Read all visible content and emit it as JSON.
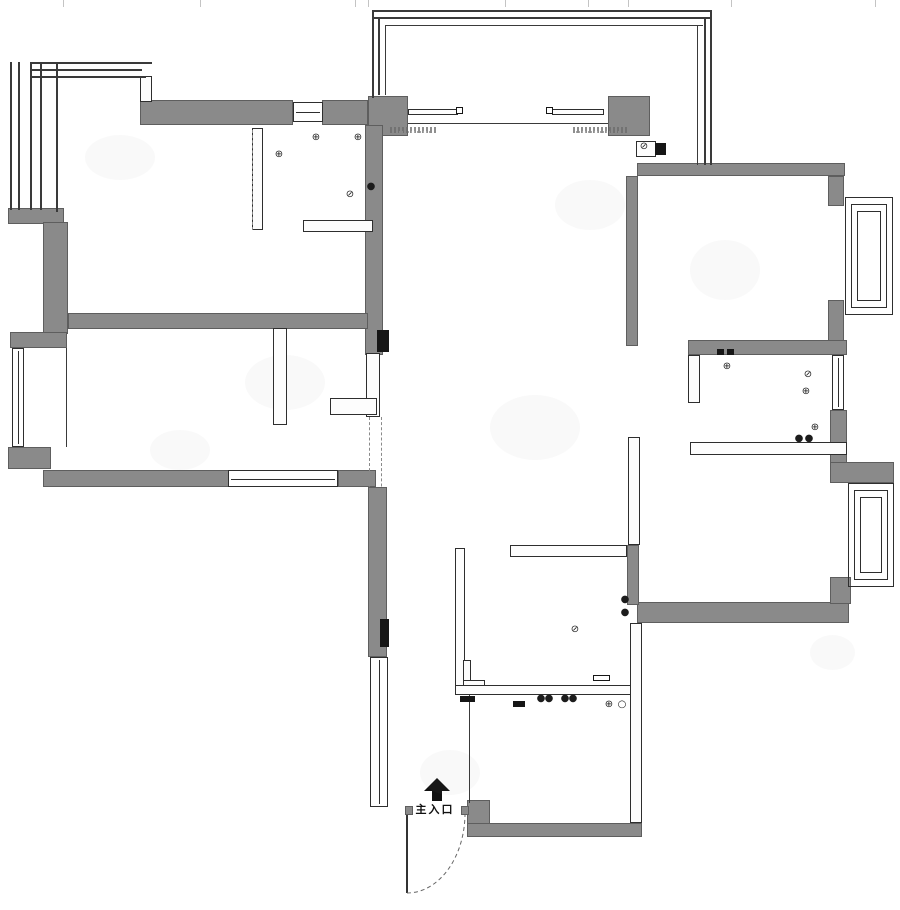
{
  "entrance": {
    "label": "主入口",
    "arrow_icon": "up-arrow-icon"
  },
  "palette": {
    "wall_fill": "#8a8a8a",
    "wall_edge": "#5e5e5e",
    "line": "#2e2e2e",
    "background": "#ffffff",
    "mark": "#161616",
    "faint": "#c4c4c4"
  },
  "plan": {
    "gray_walls": [
      [
        140,
        100,
        153,
        25
      ],
      [
        322,
        100,
        46,
        25
      ],
      [
        368,
        96,
        40,
        40
      ],
      [
        608,
        96,
        42,
        40
      ],
      [
        365,
        125,
        18,
        230
      ],
      [
        637,
        163,
        208,
        13
      ],
      [
        626,
        176,
        12,
        170
      ],
      [
        828,
        176,
        16,
        30
      ],
      [
        828,
        300,
        16,
        46
      ],
      [
        688,
        340,
        159,
        15
      ],
      [
        830,
        410,
        17,
        54
      ],
      [
        830,
        462,
        64,
        21
      ],
      [
        637,
        602,
        212,
        21
      ],
      [
        830,
        577,
        21,
        27
      ],
      [
        368,
        487,
        19,
        170
      ],
      [
        467,
        800,
        23,
        25
      ],
      [
        467,
        823,
        175,
        14
      ],
      [
        8,
        208,
        56,
        16
      ],
      [
        43,
        222,
        25,
        112
      ],
      [
        68,
        313,
        300,
        16
      ],
      [
        43,
        470,
        186,
        17
      ],
      [
        338,
        470,
        38,
        17
      ],
      [
        10,
        332,
        57,
        16
      ],
      [
        8,
        447,
        43,
        22
      ],
      [
        627,
        545,
        12,
        60
      ],
      [
        405,
        806,
        8,
        9
      ],
      [
        461,
        806,
        8,
        9
      ]
    ],
    "thin_walls": [
      [
        252,
        128,
        11,
        102
      ],
      [
        303,
        220,
        70,
        12
      ],
      [
        273,
        328,
        14,
        97
      ],
      [
        366,
        353,
        14,
        64
      ],
      [
        330,
        398,
        47,
        17
      ],
      [
        688,
        355,
        12,
        48
      ],
      [
        690,
        442,
        157,
        13
      ],
      [
        628,
        437,
        12,
        108
      ],
      [
        455,
        548,
        10,
        140
      ],
      [
        510,
        545,
        117,
        12
      ],
      [
        455,
        685,
        182,
        10
      ],
      [
        463,
        660,
        8,
        26
      ],
      [
        463,
        680,
        22,
        6
      ],
      [
        140,
        76,
        12,
        26
      ],
      [
        636,
        141,
        20,
        16
      ],
      [
        630,
        623,
        12,
        200
      ],
      [
        408,
        109,
        50,
        6
      ],
      [
        552,
        109,
        52,
        6
      ]
    ],
    "windows": [
      [
        293,
        102,
        30,
        20
      ],
      [
        228,
        470,
        110,
        17
      ],
      [
        12,
        348,
        12,
        99
      ],
      [
        832,
        355,
        12,
        55
      ],
      [
        370,
        657,
        18,
        150
      ]
    ],
    "bay_frames": [
      [
        845,
        197,
        48,
        118
      ],
      [
        851,
        204,
        36,
        104
      ],
      [
        857,
        211,
        24,
        90
      ],
      [
        848,
        483,
        46,
        104
      ],
      [
        854,
        490,
        34,
        90
      ],
      [
        860,
        497,
        22,
        76
      ]
    ],
    "frame_lines": [
      [
        372,
        10,
        340,
        2
      ],
      [
        372,
        17,
        340,
        2
      ],
      [
        385,
        25,
        318,
        1
      ],
      [
        372,
        10,
        2,
        88
      ],
      [
        378,
        17,
        2,
        78
      ],
      [
        385,
        25,
        1,
        70
      ],
      [
        710,
        10,
        2,
        155
      ],
      [
        704,
        17,
        2,
        148
      ],
      [
        697,
        25,
        1,
        140
      ],
      [
        10,
        62,
        2,
        148
      ],
      [
        18,
        62,
        2,
        148
      ],
      [
        30,
        62,
        122,
        2
      ],
      [
        30,
        69,
        112,
        2
      ],
      [
        30,
        76,
        116,
        2
      ],
      [
        30,
        62,
        2,
        148
      ],
      [
        40,
        62,
        2,
        148
      ],
      [
        56,
        62,
        2,
        150
      ],
      [
        66,
        348,
        1,
        99
      ],
      [
        469,
        695,
        1,
        108
      ],
      [
        408,
        123,
        200,
        1
      ]
    ],
    "dashed_lines": [
      [
        369,
        417,
        2,
        90
      ],
      [
        381,
        417,
        2,
        90
      ],
      [
        252,
        130,
        1,
        100
      ]
    ],
    "black_marks": [
      [
        377,
        330,
        12,
        22
      ],
      [
        380,
        619,
        9,
        28
      ],
      [
        460,
        696,
        15,
        6
      ],
      [
        513,
        701,
        12,
        6
      ],
      [
        655,
        143,
        11,
        12
      ],
      [
        717,
        349,
        7,
        6
      ],
      [
        727,
        349,
        7,
        6
      ]
    ],
    "outlined_marks": [
      [
        593,
        675,
        17,
        6
      ],
      [
        456,
        107,
        7,
        7
      ],
      [
        546,
        107,
        7,
        7
      ]
    ],
    "symbols": [
      [
        310,
        133,
        "⊕"
      ],
      [
        352,
        133,
        "⊕"
      ],
      [
        273,
        150,
        "⊕"
      ],
      [
        344,
        190,
        "⊘"
      ],
      [
        365,
        182,
        "●"
      ],
      [
        638,
        142,
        "⊘"
      ],
      [
        721,
        362,
        "⊕"
      ],
      [
        802,
        370,
        "⊘"
      ],
      [
        800,
        387,
        "⊕"
      ],
      [
        809,
        423,
        "⊕"
      ],
      [
        793,
        434,
        "●"
      ],
      [
        803,
        434,
        "●"
      ],
      [
        569,
        625,
        "⊘"
      ],
      [
        619,
        595,
        "●"
      ],
      [
        619,
        608,
        "●"
      ],
      [
        603,
        700,
        "⊕"
      ],
      [
        616,
        700,
        "○"
      ],
      [
        535,
        694,
        "●"
      ],
      [
        543,
        694,
        "●"
      ],
      [
        559,
        694,
        "●"
      ],
      [
        567,
        694,
        "●"
      ]
    ],
    "annotations": [
      [
        390,
        127,
        46
      ],
      [
        573,
        127,
        54
      ]
    ],
    "ticks": [
      63,
      200,
      355,
      368,
      505,
      588,
      628,
      731,
      875
    ],
    "smudges": [
      [
        85,
        135,
        70,
        45
      ],
      [
        245,
        355,
        80,
        55
      ],
      [
        690,
        240,
        70,
        60
      ],
      [
        490,
        395,
        90,
        65
      ],
      [
        420,
        750,
        60,
        45
      ],
      [
        810,
        635,
        45,
        35
      ],
      [
        150,
        430,
        60,
        40
      ],
      [
        555,
        180,
        70,
        50
      ]
    ]
  }
}
